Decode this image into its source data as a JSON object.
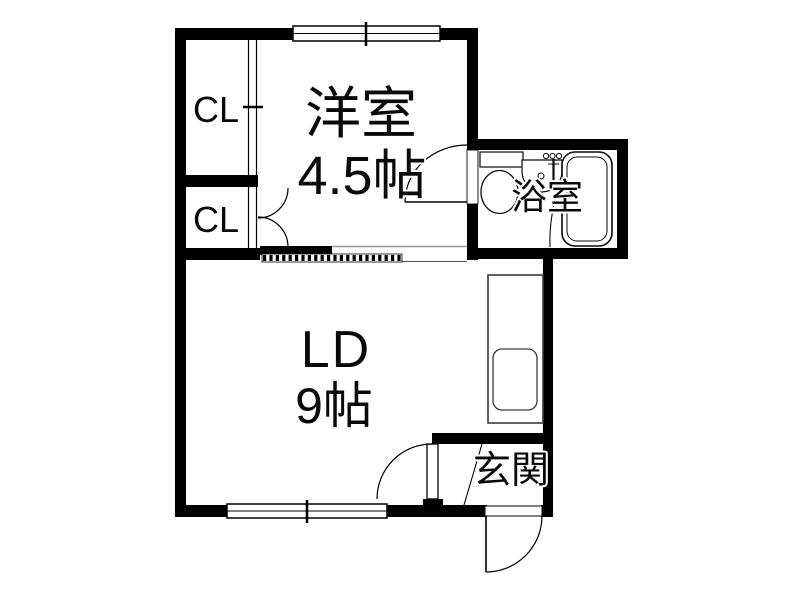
{
  "floor_plan": {
    "rooms": {
      "western_room": {
        "label": "洋室",
        "size": "4.5帖"
      },
      "living_dining": {
        "label": "LD",
        "size": "9帖"
      },
      "bathroom": {
        "label": "浴室"
      },
      "entrance": {
        "label": "玄関"
      },
      "closet_upper": {
        "label": "CL"
      },
      "closet_lower": {
        "label": "CL"
      }
    },
    "icons": {
      "toilet": "toilet-icon",
      "bathtub": "bathtub-icon",
      "washbasin": "washbasin-icon",
      "faucet": "faucet-icon",
      "kitchen_sink": "kitchen-sink-icon",
      "swing_door": "door-arc",
      "sliding_door": "dashed-track",
      "window": "double-line-window"
    },
    "colors": {
      "wall": "#000000",
      "background": "#ffffff",
      "fixture_outline": "#3a3a3a"
    }
  }
}
